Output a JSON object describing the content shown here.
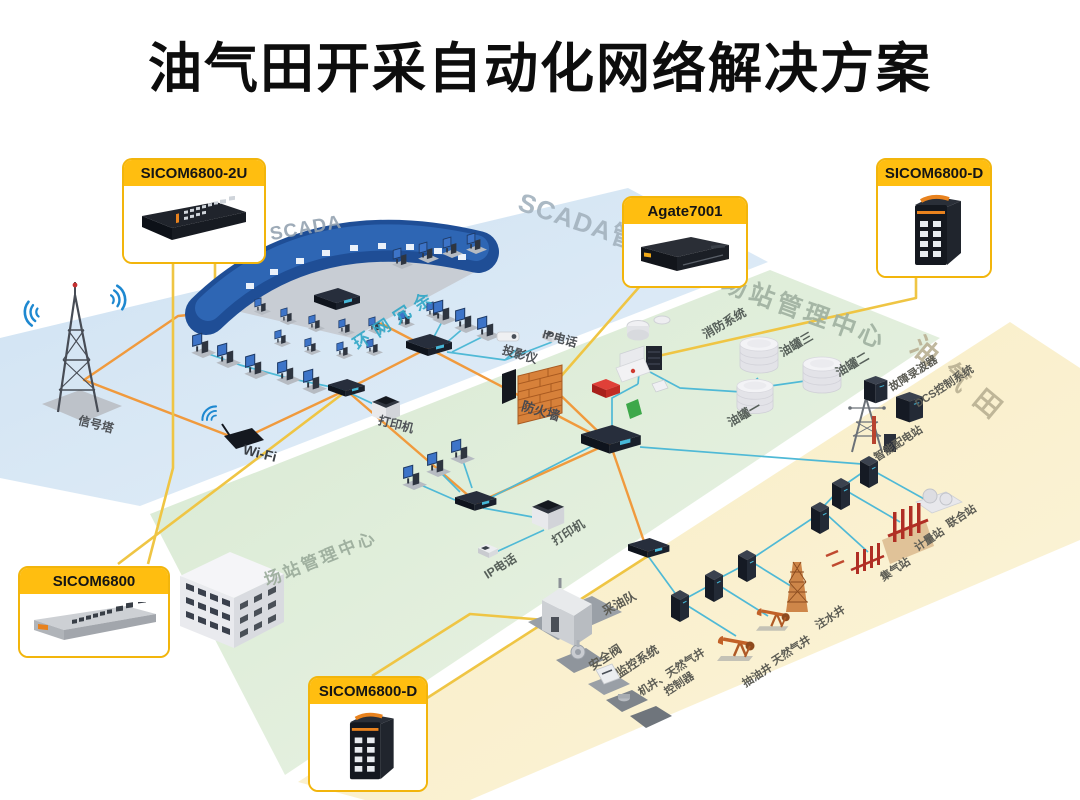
{
  "title": "油气田开采自动化网络解决方案",
  "callouts": {
    "sicom6800_2u": "SICOM6800-2U",
    "agate7001": "Agate7001",
    "sicom6800_d_top": "SICOM6800-D",
    "sicom6800": "SICOM6800",
    "sicom6800_d_bottom": "SICOM6800-D"
  },
  "zones": {
    "scada_management_center": "SCADA管理中心",
    "station_management_center_edge": "场站管理中心",
    "oil_gas_field": "油气田",
    "station_management_center_inner": "场站管理中心",
    "scada_room": "SCADA"
  },
  "labels": {
    "signal_tower": "信号塔",
    "wifi": "Wi-Fi",
    "ring_redundancy": "环网冗余",
    "printer_blue": "打印机",
    "projector": "投影仪",
    "ip_phone_blue": "IP电话",
    "firewall": "防火墙",
    "fire_system": "消防系统",
    "oil_tank_3": "油罐三",
    "oil_tank_2": "油罐二",
    "oil_tank_1": "油罐一",
    "printer_green": "打印机",
    "ip_phone_green": "IP电话",
    "fault_recorder": "故障录波器",
    "dcs_system": "DCS控制系统",
    "smart_substation": "智能配电站",
    "joint_station": "联合站",
    "metering_station": "计量站",
    "gas_gathering_station": "集气站",
    "water_injection_well": "注水井",
    "oil_production_team": "采油队",
    "safety_valve": "安全阀",
    "monitoring_system": "监控系统",
    "well_controller_line1": "机井、天然气井",
    "well_controller_line2": "控制器",
    "pumping_well": "抽油井",
    "natural_gas_well": "天然气井"
  },
  "colors": {
    "callout_header": "#FFBE10",
    "callout_border": "#F2B50C",
    "zone_blue": "#D6E7F4",
    "zone_green": "#DDECD8",
    "zone_yellow": "#FAEFCB",
    "ring_line_orange": "#F09A3D",
    "leader_line_yellow": "#EFC544",
    "device_link_cyan": "#4FB9D6",
    "ring_redundancy_text": "#2FA7C7"
  }
}
